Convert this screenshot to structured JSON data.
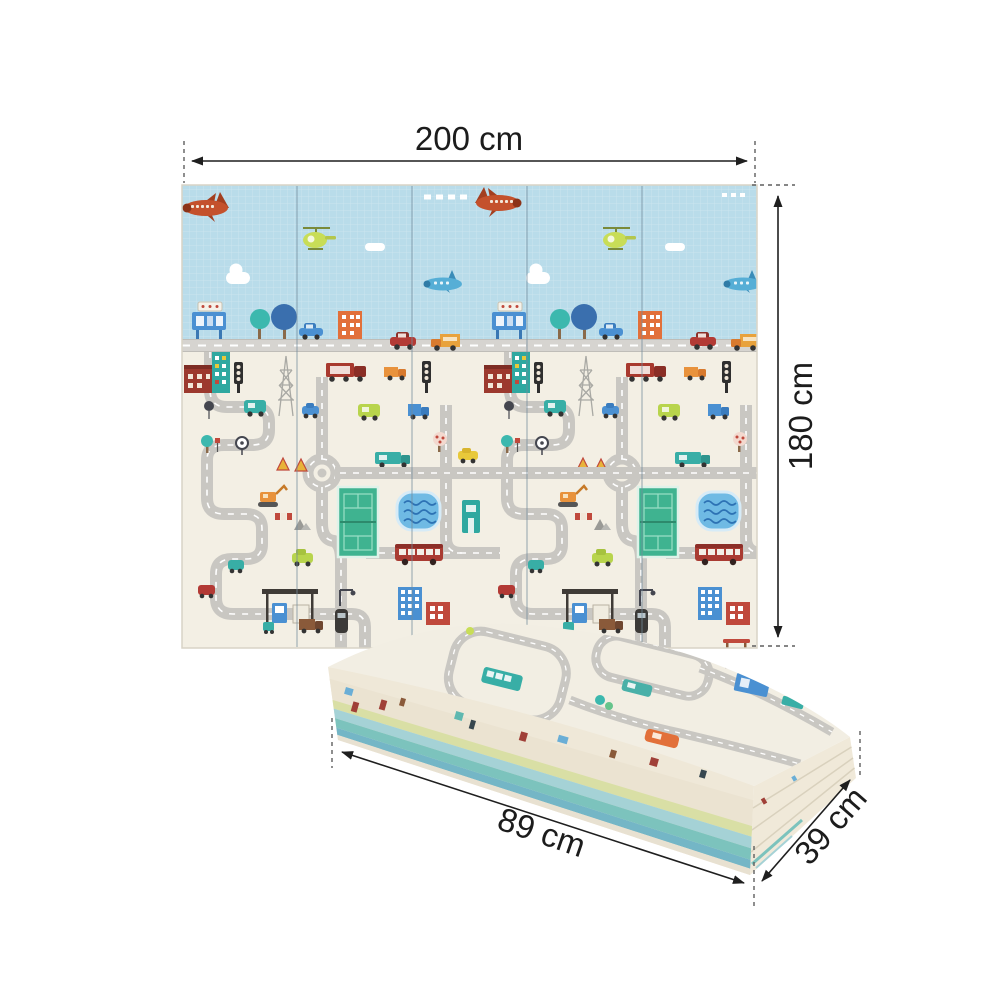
{
  "title": "Foldable baby play mat size diagram",
  "dimensions": {
    "width": "200 cm",
    "height": "180 cm",
    "folded_length": "89 cm",
    "folded_width": "39 cm"
  },
  "unfolded_mat": {
    "panels": 5,
    "theme": "city roads and traffic play mat",
    "sky_icons": [
      "airplane-icon",
      "helicopter-icon",
      "cloud-icon",
      "jet-icon",
      "contrail-icon"
    ],
    "street_icons": [
      "billboard-icon",
      "tree-icon",
      "apartment-building-icon",
      "car-icon",
      "truck-icon"
    ],
    "play_icons": [
      "road-network",
      "roundabout",
      "tennis-court",
      "swimming-pool",
      "bus-icon",
      "gas-station-icon",
      "traffic-light-icon",
      "power-pylon-icon",
      "excavator-icon",
      "warning-triangle-icon",
      "semi-truck-icon",
      "house-icon",
      "bench-icon",
      "scooter-icon"
    ]
  },
  "folded_mat": {
    "view": "folded stack in perspective",
    "top_icons": [
      "road-loop",
      "bus-icon",
      "car-icon",
      "shop-icon",
      "tree-icon"
    ],
    "edge_stripes": [
      "cream",
      "printed",
      "lime",
      "cyan",
      "teal",
      "blue",
      "cream"
    ]
  },
  "colors": {
    "background": "#ffffff",
    "sky": "#b9dcea",
    "mat_base": "#f3efe4",
    "road": "#c9c7c2",
    "band_road": "#d6d4d0",
    "accent_red": "#a93b32",
    "accent_teal": "#38aea6",
    "accent_orange": "#e2703a",
    "accent_blue": "#4a90d2",
    "accent_lime": "#b8d44c",
    "pool_blue": "#6fbae4",
    "court_green": "#3fb390",
    "dimension_text": "#1c1c1c"
  }
}
